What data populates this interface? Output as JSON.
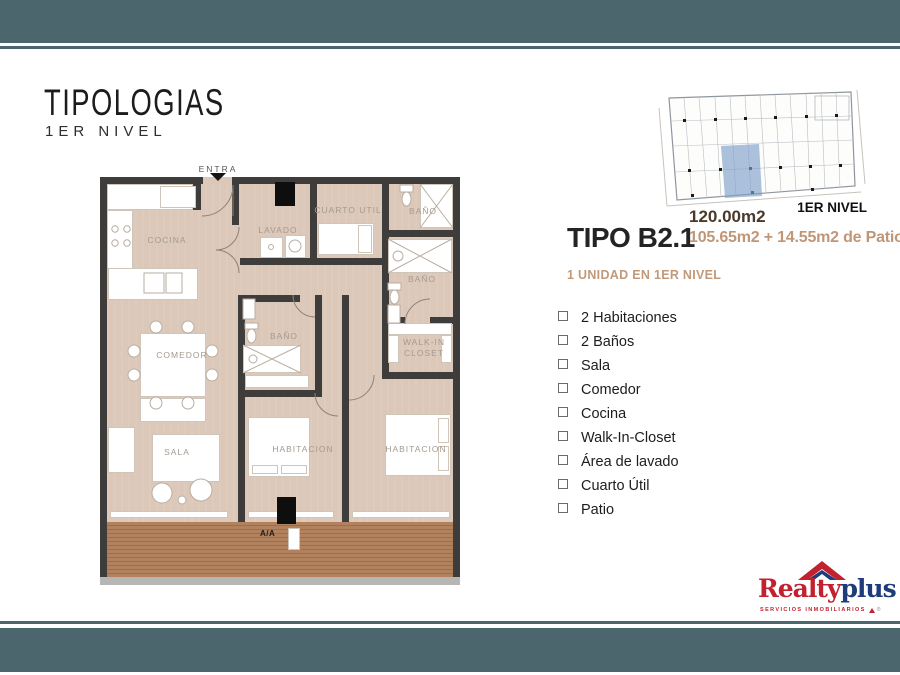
{
  "header": {
    "title": "TIPOLOGIAS",
    "subtitle": "1ER NIVEL"
  },
  "mini_plan": {
    "caption": "1ER NIVEL"
  },
  "unit": {
    "name": "TIPO B2.1",
    "total_area": "120.00m2",
    "area_detail": "105.65m2 + 14.55m2 de Patio",
    "availability": "1 UNIDAD EN 1ER NIVEL"
  },
  "features": [
    "2 Habitaciones",
    "2 Baños",
    "Sala",
    "Comedor",
    "Cocina",
    "Walk-In-Closet",
    "Área de lavado",
    "Cuarto Útil",
    "Patio"
  ],
  "plan": {
    "entry_label": "ENTRA",
    "ac_label": "A/A",
    "rooms": {
      "cocina": "COCINA",
      "lavado": "LAVADO",
      "cuarto_util": "CUARTO UTIL",
      "bano1": "BAÑO",
      "bano2": "BAÑO",
      "bano3": "BAÑO",
      "walkin": "WALK-IN CLOSET",
      "comedor": "COMEDOR",
      "sala": "SALA",
      "habitacion1": "HABITACION",
      "habitacion2": "HABITACION"
    }
  },
  "logo": {
    "brand_red": "Realty",
    "brand_blue": "plus",
    "tagline": "SERVICIOS INMOBILIARIOS",
    "registered": "®"
  },
  "colors": {
    "band_teal": "#4c666d",
    "accent_tan": "#c09677",
    "accent_brown": "#4a392b",
    "floor_tan": "#dcc8b9",
    "wall_dark": "#3e3d3b",
    "deck_brown": "#b2815d",
    "logo_red": "#c2212f",
    "logo_blue": "#1e3c7b",
    "plan_highlight": "#7f9fca"
  }
}
